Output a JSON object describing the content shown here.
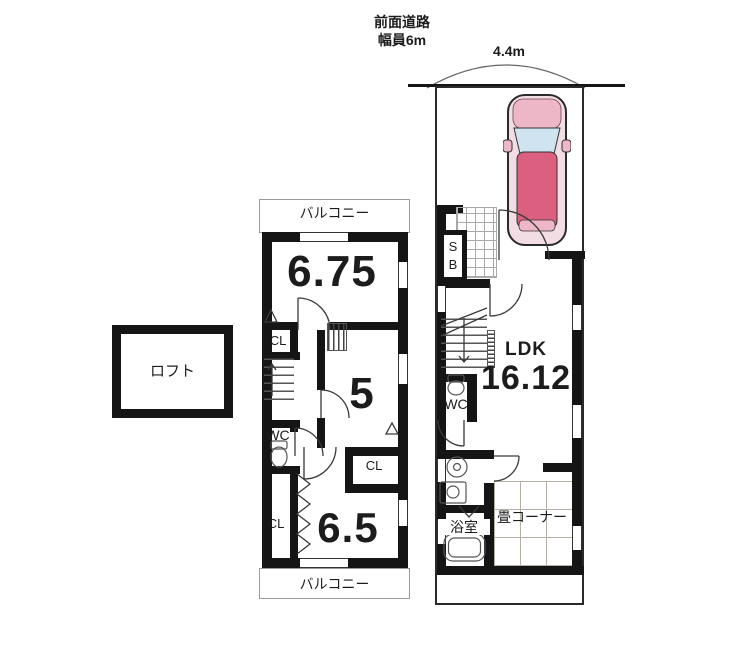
{
  "annotations": {
    "road_line1": "前面道路",
    "road_line2": "幅員6m",
    "frontage": "4.4m"
  },
  "loft": {
    "label": "ロフト"
  },
  "floor2": {
    "balcony_top": "バルコニー",
    "balcony_bottom": "バルコニー",
    "room_675": "6.75",
    "room_5": "5",
    "room_65": "6.5",
    "cl_top": "CL",
    "cl_mid": "CL",
    "cl_bottom": "CL",
    "wc": "WC"
  },
  "floor1": {
    "shoe_s": "S",
    "shoe_b": "B",
    "ldk_label": "LDK",
    "ldk_size": "16.12",
    "wc": "WC",
    "bath": "浴室",
    "tatami": "畳コーナー"
  },
  "colors": {
    "wall": "#151515",
    "line": "#3a3a3a",
    "car_body": "#db5f7e",
    "car_glass": "#cfe3f1"
  }
}
